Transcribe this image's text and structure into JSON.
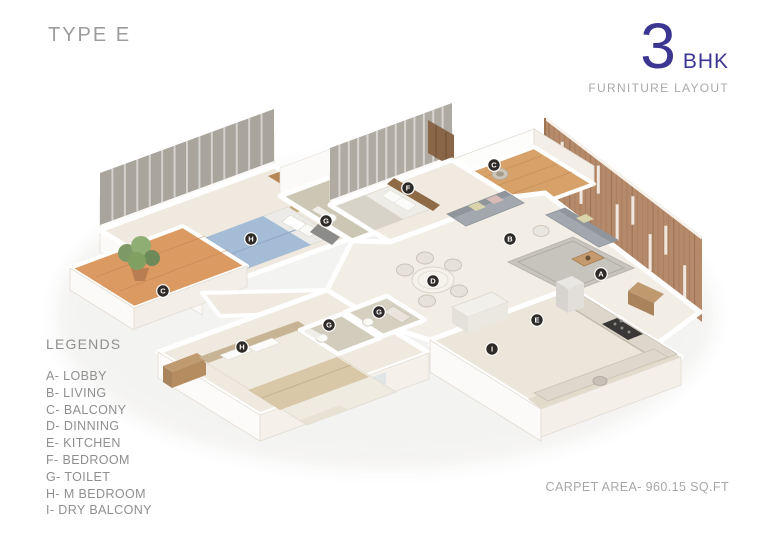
{
  "title": "TYPE E",
  "unit": {
    "number": "3",
    "label": "BHK",
    "subtitle": "FURNITURE LAYOUT"
  },
  "legend": {
    "title": "LEGENDS",
    "items": [
      "A- LOBBY",
      "B- LIVING",
      "C- BALCONY",
      "D- DINNING",
      "E- KITCHEN",
      "F- BEDROOM",
      "G- TOILET",
      "H- M BEDROOM",
      "I- DRY BALCONY"
    ]
  },
  "footer": {
    "carpet_area": "CARPET AREA- 960.15 SQ.FT"
  },
  "colors": {
    "accent": "#3b3691",
    "muted_text": "#9c9c9c",
    "legend_text": "#8f8f8f",
    "marker_bg": "#2e2a27",
    "wood_wall": "#b58a6a",
    "terracotta_balcony": "#dc9a63",
    "deck_wood": "#d7a269",
    "blue_bed": "#a4bcd6",
    "floor_cream": "#efe9e0"
  },
  "plan": {
    "markers": [
      {
        "letter": "A",
        "room": "lobby",
        "x": 601,
        "y": 274
      },
      {
        "letter": "B",
        "room": "living",
        "x": 510,
        "y": 239
      },
      {
        "letter": "C",
        "room": "balcony",
        "x": 163,
        "y": 291
      },
      {
        "letter": "C",
        "room": "balcony",
        "x": 494,
        "y": 165
      },
      {
        "letter": "D",
        "room": "dinning",
        "x": 433,
        "y": 281
      },
      {
        "letter": "E",
        "room": "kitchen",
        "x": 537,
        "y": 320
      },
      {
        "letter": "F",
        "room": "bedroom",
        "x": 408,
        "y": 188
      },
      {
        "letter": "G",
        "room": "toilet",
        "x": 326,
        "y": 221
      },
      {
        "letter": "G",
        "room": "toilet",
        "x": 329,
        "y": 325
      },
      {
        "letter": "G",
        "room": "toilet",
        "x": 379,
        "y": 312
      },
      {
        "letter": "H",
        "room": "m-bedroom",
        "x": 251,
        "y": 239
      },
      {
        "letter": "H",
        "room": "m-bedroom",
        "x": 242,
        "y": 347
      },
      {
        "letter": "I",
        "room": "dry-balcony",
        "x": 492,
        "y": 349
      }
    ]
  }
}
